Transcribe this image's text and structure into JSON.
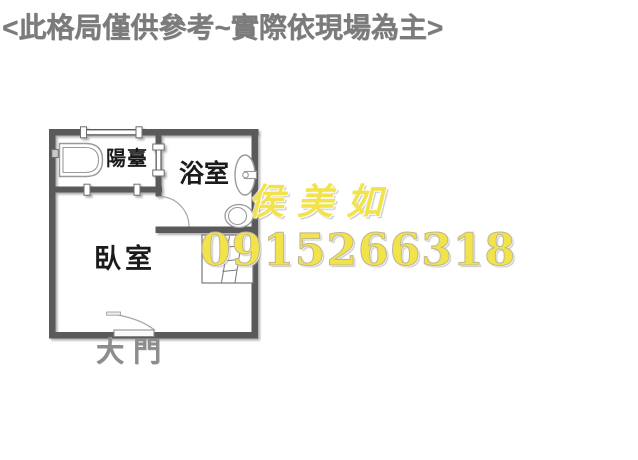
{
  "header": {
    "disclaimer": "<此格局僅供參考~實際依現場為主>"
  },
  "floorplan": {
    "rooms": {
      "balcony": {
        "label": "陽臺"
      },
      "bathroom": {
        "label": "浴室"
      },
      "bedroom": {
        "label": "臥室"
      }
    },
    "entrance": {
      "label": "大門"
    },
    "icons": [
      "washing-machine-icon",
      "window-tick-icon",
      "sink-icon",
      "toilet-icon",
      "door-swing-arc-icon",
      "ladder-icon"
    ],
    "colors": {
      "wall": "#5a5a5a",
      "fixture_line": "#9a9a9a",
      "room_label": "#1b1b1b",
      "entrance_label": "#8d8d8d"
    }
  },
  "watermark": {
    "agent_name": "侯美如",
    "phone": "0915266318",
    "color": "#f2e34b"
  }
}
